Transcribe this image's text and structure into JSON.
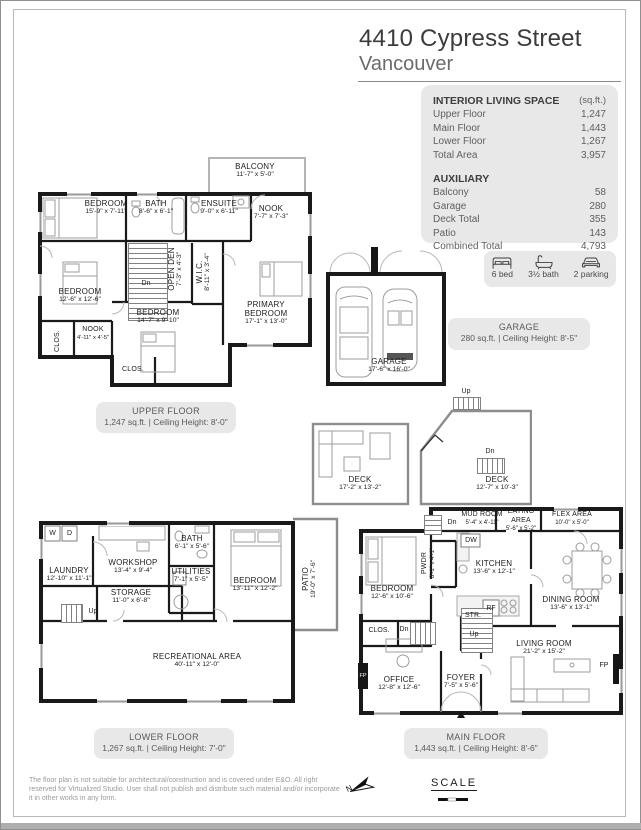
{
  "header": {
    "title": "4410 Cypress Street",
    "subtitle": "Vancouver"
  },
  "summary": {
    "interior_heading": "INTERIOR LIVING SPACE",
    "interior_unit": "(sq.ft.)",
    "interior_rows": [
      {
        "label": "Upper Floor",
        "value": "1,247"
      },
      {
        "label": "Main Floor",
        "value": "1,443"
      },
      {
        "label": "Lower Floor",
        "value": "1,267"
      },
      {
        "label": "Total Area",
        "value": "3,957"
      }
    ],
    "auxiliary_heading": "AUXILIARY",
    "auxiliary_rows": [
      {
        "label": "Balcony",
        "value": "58"
      },
      {
        "label": "Garage",
        "value": "280"
      },
      {
        "label": "Deck Total",
        "value": "355"
      },
      {
        "label": "Patio",
        "value": "143"
      },
      {
        "label": "Combined Total",
        "value": "4,793"
      }
    ]
  },
  "features": {
    "bed": "6 bed",
    "bath": "3½ bath",
    "parking": "2 parking"
  },
  "garage_box": {
    "name": "GARAGE",
    "info": "280 sq.ft. | Ceiling Height: 8'-5\""
  },
  "floor_boxes": {
    "upper": {
      "name": "UPPER FLOOR",
      "info": "1,247 sq.ft. | Ceiling Height: 8'-0\""
    },
    "lower": {
      "name": "LOWER FLOOR",
      "info": "1,267 sq.ft. | Ceiling Height: 7'-0\""
    },
    "main": {
      "name": "MAIN FLOOR",
      "info": "1,443 sq.ft. | Ceiling Height: 8'-6\""
    }
  },
  "plans": {
    "upper": {
      "balcony": {
        "name": "BALCONY",
        "dims": "11'-7\" x 5'-0\""
      },
      "bedroom1": {
        "name": "BEDROOM",
        "dims": "15'-9\" x 7'-11\""
      },
      "bath": {
        "name": "BATH",
        "dims": "8'-6\" x 6'-1\""
      },
      "ensuite": {
        "name": "ENSUITE",
        "dims": "9'-0\" x 6'-11\""
      },
      "nook": {
        "name": "NOOK",
        "dims": "7'-7\" x 7'-3\""
      },
      "bedroom2": {
        "name": "BEDROOM",
        "dims": "12'-6\" x 12'-6\""
      },
      "open_den": {
        "name": "OPEN DEN",
        "dims": "7'-3\" x 4'-3\""
      },
      "wic": {
        "name": "W.I.C.",
        "dims": "8'-11\" x 3'-4\""
      },
      "primary": {
        "name": "PRIMARY BEDROOM",
        "dims": "17'-1\" x 13'-0\""
      },
      "bedroom3": {
        "name": "BEDROOM",
        "dims": "14'-7\" x 9'-10\""
      },
      "nook2": {
        "name": "NOOK",
        "dims": "4'-11\" x 4'-5\""
      },
      "clos1": "CLOS.",
      "clos2": "CLOS.",
      "dn": "Dn"
    },
    "garage": {
      "name": "GARAGE",
      "dims": "17'-6\" x 16'-0\""
    },
    "decks": {
      "deck1": {
        "name": "DECK",
        "dims": "17'-2\" x 13'-2\""
      },
      "deck2": {
        "name": "DECK",
        "dims": "12'-7\" x 10'-3\""
      },
      "up": "Up",
      "dn": "Dn"
    },
    "lower": {
      "laundry": {
        "name": "LAUNDRY",
        "dims": "12'-10\" x 11'-1\""
      },
      "workshop": {
        "name": "WORKSHOP",
        "dims": "13'-4\" x 9'-4\""
      },
      "bath": {
        "name": "BATH",
        "dims": "6'-1\" x 5'-6\""
      },
      "utilities": {
        "name": "UTILITIES",
        "dims": "7'-1\" x 5'-5\""
      },
      "bedroom": {
        "name": "BEDROOM",
        "dims": "13'-11\" x 12'-2\""
      },
      "storage": {
        "name": "STORAGE",
        "dims": "11'-0\" x 6'-8\""
      },
      "rec": {
        "name": "RECREATIONAL AREA",
        "dims": "40'-11\" x 12'-0\""
      },
      "patio": {
        "name": "PATIO",
        "dims": "19'-0\" x 7'-6\""
      },
      "washer": "W",
      "dryer": "D",
      "up": "Up"
    },
    "main": {
      "mud": {
        "name": "MUD ROOM",
        "dims": "5'-4\" x 4'-11\""
      },
      "eating": {
        "name": "EATING AREA",
        "dims": "5'-6\" x 5'-2\""
      },
      "flex": {
        "name": "FLEX AREA",
        "dims": "10'-0\" x 5'-0\""
      },
      "kitchen": {
        "name": "KITCHEN",
        "dims": "13'-6\" x 12'-1\""
      },
      "pwdr": {
        "name": "PWDR",
        "dims": "8'-1\" x 4'-1\""
      },
      "bedroom": {
        "name": "BEDROOM",
        "dims": "12'-6\" x 10'-6\""
      },
      "dining": {
        "name": "DINING ROOM",
        "dims": "13'-6\" x 13'-1\""
      },
      "living": {
        "name": "LIVING ROOM",
        "dims": "21'-2\" x 15'-2\""
      },
      "office": {
        "name": "OFFICE",
        "dims": "12'-8\" x 12'-6\""
      },
      "foyer": {
        "name": "FOYER",
        "dims": "7'-5\" x 5'-6\""
      },
      "clos": "CLOS.",
      "str": "STR.",
      "dn": "Dn",
      "up": "Up",
      "dw": "DW",
      "rf": "RF",
      "fp": "FP"
    }
  },
  "footer": {
    "disclaimer": "The floor plan is not suitable for architectural/construction and is covered under E&O. All right reserved for Virtualized Studio. User shall not publish and distribute such material and/or incorporate it in other works in any form.",
    "scale_label": "SCALE",
    "north_label": "N"
  },
  "colors": {
    "box_bg": "#e8e8e8",
    "wall": "#1a1a1a"
  }
}
